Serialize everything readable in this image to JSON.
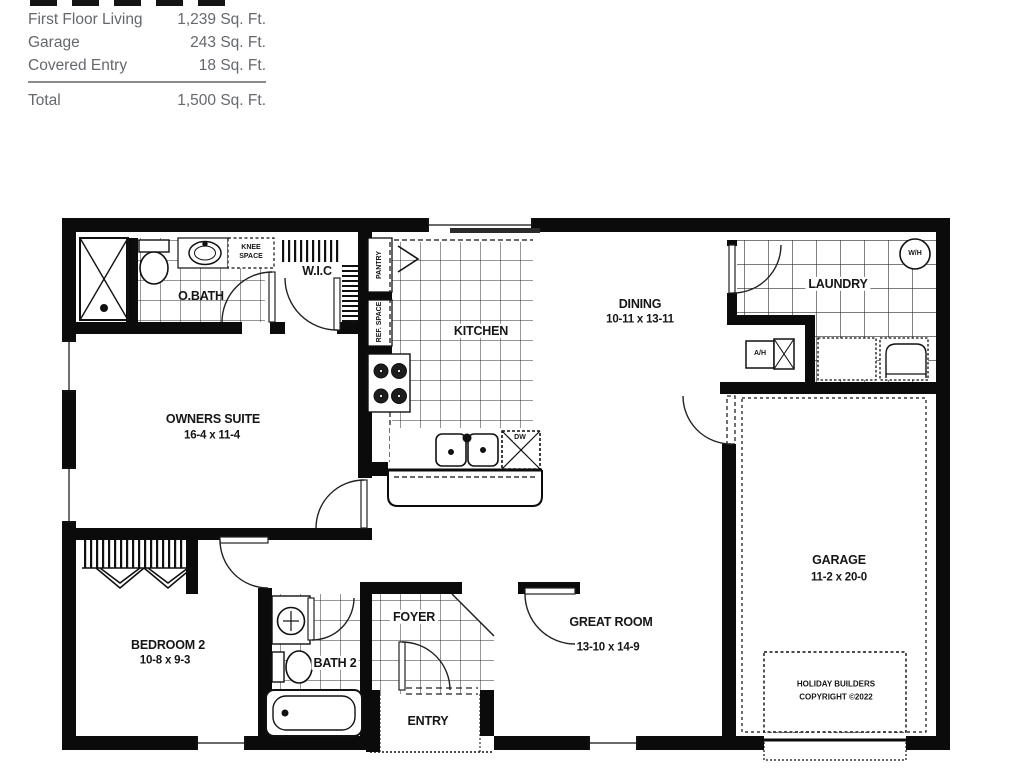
{
  "header": {
    "area_table": {
      "rows": [
        {
          "label": "First Floor Living",
          "value": "1,239 Sq. Ft."
        },
        {
          "label": "Garage",
          "value": "243 Sq. Ft."
        },
        {
          "label": "Covered Entry",
          "value": "18 Sq. Ft."
        }
      ],
      "total_label": "Total",
      "total_value": "1,500 Sq. Ft."
    }
  },
  "plan": {
    "rooms": {
      "obath": "O.BATH",
      "wic": "W.I.C",
      "kitchen": "KITCHEN",
      "dining_name": "DINING",
      "dining_dims": "10-11 x 13-11",
      "laundry": "LAUNDRY",
      "owners_name": "OWNERS SUITE",
      "owners_dims": "16-4 x 11-4",
      "garage_name": "GARAGE",
      "garage_dims": "11-2 x 20-0",
      "bedroom2_name": "BEDROOM 2",
      "bedroom2_dims": "10-8 x 9-3",
      "bath2": "BATH 2",
      "foyer": "FOYER",
      "entry": "ENTRY",
      "great_name": "GREAT ROOM",
      "great_dims": "13-10 x 14-9"
    },
    "annotations": {
      "knee_line1": "KNEE",
      "knee_line2": "SPACE",
      "pantry": "PANTRY",
      "ref_space": "REF. SPACE",
      "wh": "W/H",
      "ah": "A/H",
      "dw": "DW"
    },
    "copyright_line1": "HOLIDAY BUILDERS",
    "copyright_line2": "COPYRIGHT ©2022"
  },
  "colors": {
    "ink": "#0b0b0b",
    "label_text": "#161616",
    "table_text": "#65686c"
  }
}
